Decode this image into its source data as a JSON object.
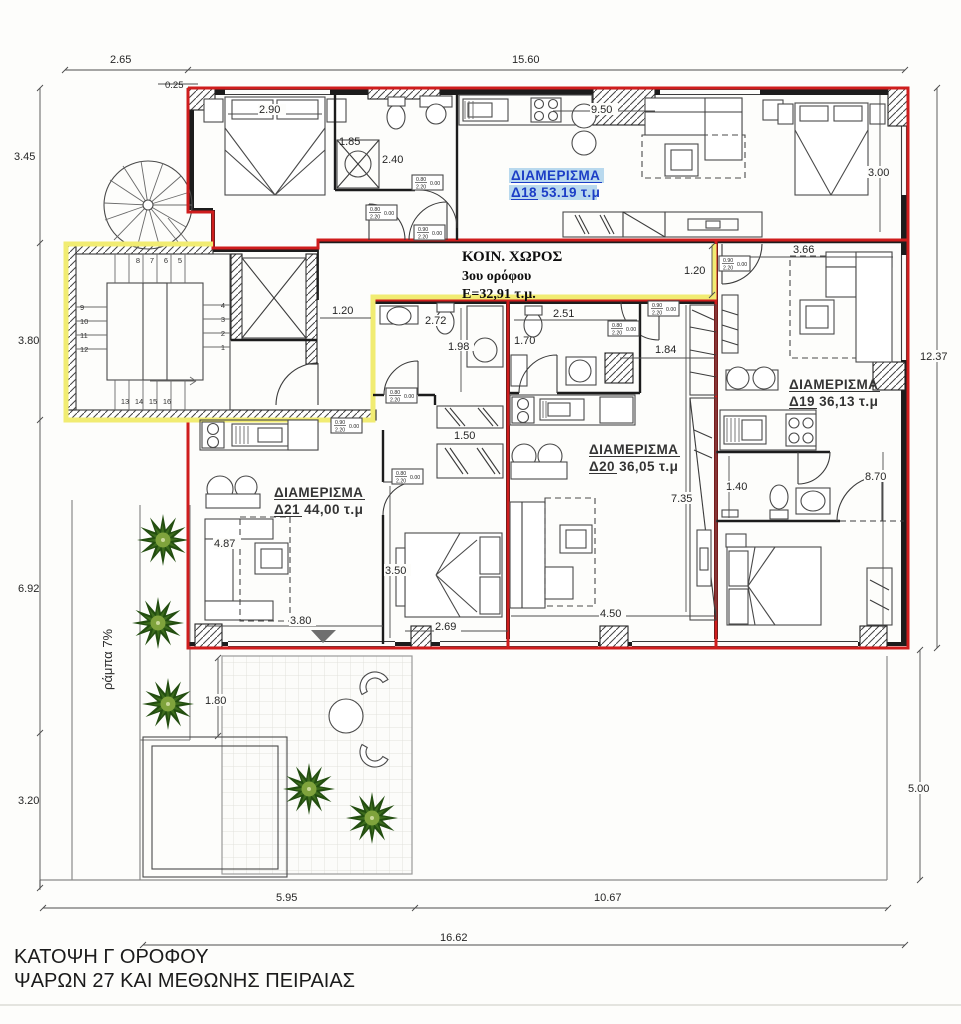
{
  "title_block": {
    "line1": "ΚΑΤΟΨΗ Γ ΟΡΟΦΟΥ",
    "line2": "ΨΑΡΩΝ 27 ΚΑΙ ΜΕΘΩΝΗΣ ΠΕΙΡΑΙΑΣ"
  },
  "common_area": {
    "name": "ΚΟΙΝ. ΧΩΡΟΣ",
    "floor": "3ου ορόφου",
    "area": "Ε=32,91 τ.μ."
  },
  "apartments": {
    "d18": {
      "label": "ΔΙΑΜΕΡΙΣΜΑ",
      "info": "Δ18 53.19 τ.μ",
      "highlighted": true
    },
    "d19": {
      "label": "ΔΙΑΜΕΡΙΣΜΑ",
      "info": "Δ19 36,13 τ.μ",
      "highlighted": false
    },
    "d20": {
      "label": "ΔΙΑΜΕΡΙΣΜΑ",
      "info": "Δ20 36,05 τ.μ",
      "highlighted": false
    },
    "d21": {
      "label": "ΔΙΑΜΕΡΙΣΜΑ",
      "info": "Δ21 44,00 τ.μ",
      "highlighted": false
    }
  },
  "exterior_dimensions": {
    "top_left": "2.65",
    "top_main": "15.60",
    "top_offset": "0.25",
    "left_upper": "3.45",
    "left_mid": "3.80",
    "left_lower": "6.92",
    "left_bottom": "3.20",
    "right_upper": "12.37",
    "right_lower": "5.00",
    "bottom_left": "5.95",
    "bottom_right": "10.67",
    "bottom_total": "16.62"
  },
  "interior_dimensions": {
    "bed_18": "2.90",
    "shower_18": "1.85",
    "hall_18": "2.40",
    "kitchen_18": "9.50",
    "bed_18_right": "3.00",
    "corridor_left": "1.20",
    "corridor_right": "1.20",
    "d19_top": "3.66",
    "d19_bath": "1.40",
    "d19_length": "8.70",
    "d20_bath_width": "2.51",
    "d20_bath_depth": "1.70",
    "d20_closet": "1.84",
    "d20_length": "7.35",
    "d20_living": "4.50",
    "d21_bath_width": "2.72",
    "d21_bath_depth": "1.98",
    "d21_closet": "1.50",
    "d21_living_width": "4.87",
    "d21_living": "3.80",
    "d21_bed_depth": "3.50",
    "d21_bed_width": "2.69",
    "terrace": "1.80"
  },
  "ramp_label": "ράμπα 7%",
  "door_tags": {
    "w_80": "0.80",
    "w_90": "0.90",
    "height": "2.20",
    "level": "0.00"
  },
  "stairs": {
    "numbers": [
      "1",
      "2",
      "3",
      "4",
      "5",
      "6",
      "7",
      "8",
      "9",
      "10",
      "11",
      "12",
      "13",
      "14",
      "15",
      "16"
    ]
  },
  "colors": {
    "apartment_outline": "#cf1d1d",
    "common_outline": "#f1ec72",
    "highlight_text": "#1c3ec6",
    "highlight_bg": "#b9d9ee",
    "walls": "#1c1c1c",
    "tree_dark": "#234e10",
    "tree_light": "#7fa33c"
  }
}
